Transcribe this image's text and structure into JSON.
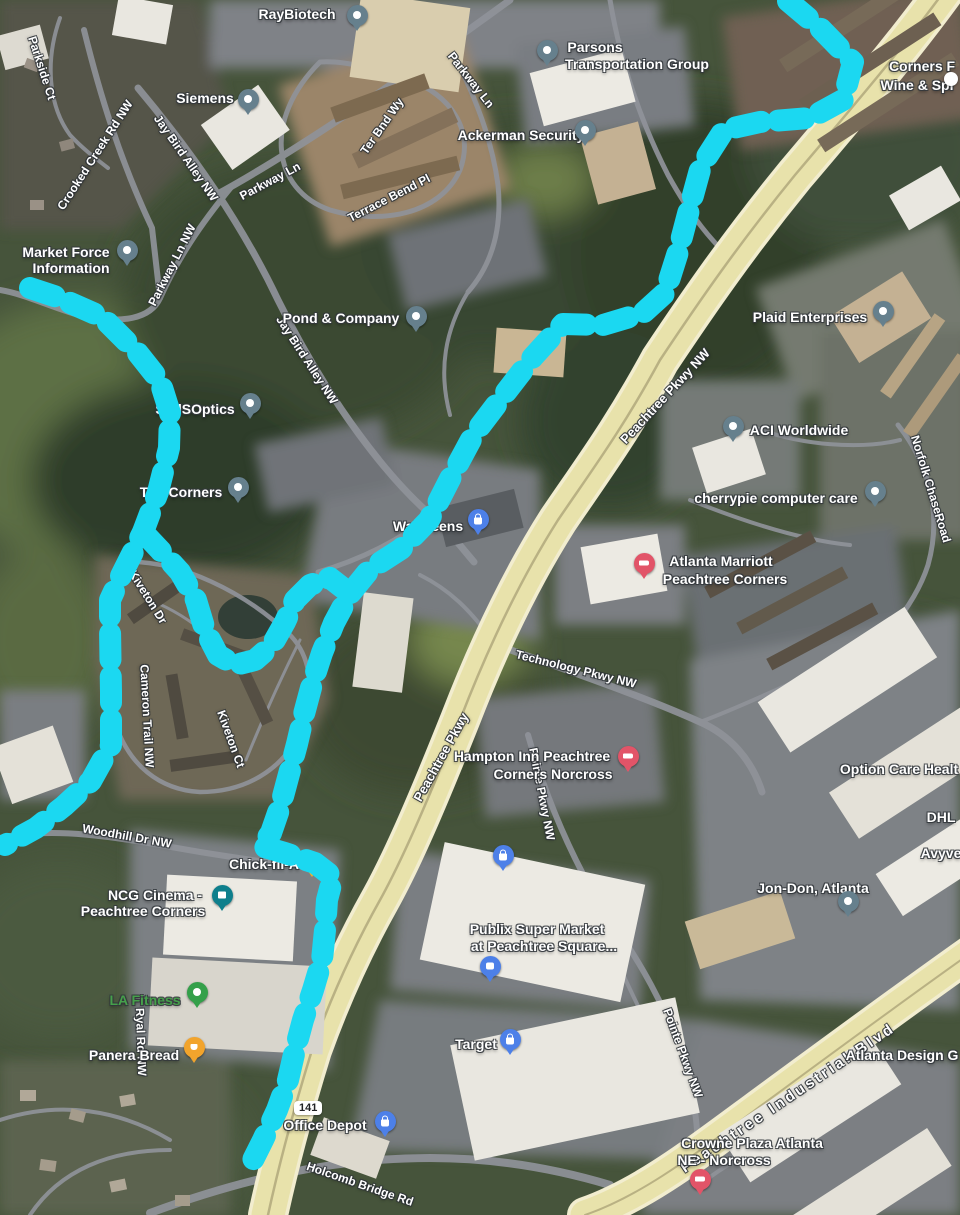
{
  "map_type": "satellite",
  "accent_colors": {
    "route_cyan": "#1bd8f1",
    "highway_fill": "#e8e2ab",
    "pin_generic": "#66808d",
    "pin_shopping": "#4d80e8",
    "pin_hotel": "#e25468",
    "pin_food": "#f2a42c",
    "pin_fitness": "#34a04a",
    "pin_movie": "#0e7f8c",
    "la_fitness_text": "#46a04b"
  },
  "shield": {
    "label": "141",
    "x": 307,
    "y": 1110
  },
  "place_labels": [
    {
      "name": "raybiotech",
      "text": "RayBiotech",
      "x": 297,
      "y": 14
    },
    {
      "name": "parsons-line1",
      "text": "Parsons",
      "x": 595,
      "y": 47
    },
    {
      "name": "parsons-line2",
      "text": "Transportation Group",
      "x": 637,
      "y": 64
    },
    {
      "name": "siemens",
      "text": "Siemens",
      "x": 205,
      "y": 98
    },
    {
      "name": "ackerman-security",
      "text": "Ackerman Security",
      "x": 521,
      "y": 135
    },
    {
      "name": "corners-wine-line1",
      "text": "Corners F",
      "x": 922,
      "y": 66
    },
    {
      "name": "corners-wine-line2",
      "text": "Wine & Spi",
      "x": 917,
      "y": 85
    },
    {
      "name": "market-force-line1",
      "text": "Market Force",
      "x": 66,
      "y": 252
    },
    {
      "name": "market-force-line2",
      "text": "Information",
      "x": 71,
      "y": 268
    },
    {
      "name": "pond-company",
      "text": "Pond & Company",
      "x": 341,
      "y": 318
    },
    {
      "name": "plaid-enterprises",
      "text": "Plaid Enterprises",
      "x": 810,
      "y": 317
    },
    {
      "name": "sddsoptics",
      "text": "SddSOptics",
      "x": 195,
      "y": 409
    },
    {
      "name": "aci-worldwide",
      "text": "ACI Worldwide",
      "x": 799,
      "y": 430
    },
    {
      "name": "cherrypie",
      "text": "cherrypie computer care",
      "x": 776,
      "y": 498
    },
    {
      "name": "the-corners",
      "text": "The Corners",
      "x": 181,
      "y": 492
    },
    {
      "name": "walgreens",
      "text": "Walgreens",
      "x": 428,
      "y": 526
    },
    {
      "name": "marriott-line1",
      "text": "Atlanta Marriott",
      "x": 721,
      "y": 561
    },
    {
      "name": "marriott-line2",
      "text": "Peachtree Corners",
      "x": 725,
      "y": 579
    },
    {
      "name": "hampton-line1",
      "text": "Hampton Inn Peachtree",
      "x": 532,
      "y": 756
    },
    {
      "name": "hampton-line2",
      "text": "Corners Norcross",
      "x": 553,
      "y": 774
    },
    {
      "name": "option-care",
      "text": "Option Care Healt",
      "x": 899,
      "y": 769
    },
    {
      "name": "dhl",
      "text": "DHL",
      "x": 941,
      "y": 817
    },
    {
      "name": "avyve",
      "text": "Avyve",
      "x": 941,
      "y": 853
    },
    {
      "name": "jon-don",
      "text": "Jon-Don, Atlanta",
      "x": 813,
      "y": 888
    },
    {
      "name": "chick-fil-a",
      "text": "Chick-fil-A",
      "x": 264,
      "y": 864
    },
    {
      "name": "ncg-line1",
      "text": "NCG Cinema -",
      "x": 155,
      "y": 895
    },
    {
      "name": "ncg-line2",
      "text": "Peachtree Corners",
      "x": 143,
      "y": 911
    },
    {
      "name": "publix-line1",
      "text": "Publix Super Market",
      "x": 537,
      "y": 929
    },
    {
      "name": "publix-line2",
      "text": "at Peachtree Square...",
      "x": 544,
      "y": 946
    },
    {
      "name": "la-fitness",
      "text": "LA Fitness",
      "x": 145,
      "y": 1000,
      "color": "#46a04b"
    },
    {
      "name": "panera-bread",
      "text": "Panera Bread",
      "x": 134,
      "y": 1055
    },
    {
      "name": "target",
      "text": "Target",
      "x": 476,
      "y": 1044
    },
    {
      "name": "atlanta-design",
      "text": "Atlanta Design G",
      "x": 902,
      "y": 1055
    },
    {
      "name": "office-depot",
      "text": "Office Depot",
      "x": 325,
      "y": 1125
    },
    {
      "name": "crowne-line1",
      "text": "Crowne Plaza Atlanta",
      "x": 752,
      "y": 1143
    },
    {
      "name": "crowne-line2",
      "text": "NE - Norcross",
      "x": 724,
      "y": 1160
    }
  ],
  "road_labels": [
    {
      "name": "parkside-ct",
      "text": "Parkside Ct",
      "x": 42,
      "y": 68,
      "rot": 72,
      "size": 12
    },
    {
      "name": "crooked-creek-rd",
      "text": "Crooked Creek Rd NW",
      "x": 95,
      "y": 155,
      "rot": -57,
      "size": 12
    },
    {
      "name": "jay-bird-alley-1",
      "text": "Jay Bird Alley NW",
      "x": 186,
      "y": 158,
      "rot": 55,
      "size": 12
    },
    {
      "name": "parkway-ln-1",
      "text": "Parkway Ln",
      "x": 270,
      "y": 181,
      "rot": -28,
      "size": 12
    },
    {
      "name": "parkway-ln-2",
      "text": "Parkway Ln",
      "x": 471,
      "y": 80,
      "rot": 52,
      "size": 12
    },
    {
      "name": "ter-bnd-wy",
      "text": "Ter Bnd Wy",
      "x": 382,
      "y": 126,
      "rot": -55,
      "size": 12
    },
    {
      "name": "terrace-bend-pl",
      "text": "Terrace Bend Pl",
      "x": 389,
      "y": 198,
      "rot": -27,
      "size": 12
    },
    {
      "name": "parkway-ln-nw",
      "text": "Parkway Ln NW",
      "x": 172,
      "y": 265,
      "rot": -63,
      "size": 12
    },
    {
      "name": "jay-bird-alley-2",
      "text": "Jay Bird Alley NW",
      "x": 307,
      "y": 360,
      "rot": 57,
      "size": 12
    },
    {
      "name": "peachtree-pkwy-nw",
      "text": "Peachtree Pkwy NW",
      "x": 665,
      "y": 396,
      "rot": -47,
      "size": 13
    },
    {
      "name": "norfolk-chase-road",
      "text": "Norfolk ChaseRoad",
      "x": 931,
      "y": 489,
      "rot": 73,
      "size": 12
    },
    {
      "name": "technology-pkwy",
      "text": "Technology Pkwy NW",
      "x": 576,
      "y": 669,
      "rot": 14,
      "size": 12
    },
    {
      "name": "peachtree-pkwy",
      "text": "Peachtree Pkwy",
      "x": 441,
      "y": 757,
      "rot": -61,
      "size": 13
    },
    {
      "name": "pointe-pkwy-1",
      "text": "Pointe Pkwy NW",
      "x": 542,
      "y": 794,
      "rot": 79,
      "size": 12
    },
    {
      "name": "kiveton-dr",
      "text": "Kiveton Dr",
      "x": 148,
      "y": 597,
      "rot": 58,
      "size": 12
    },
    {
      "name": "cameron-trail",
      "text": "Cameron Trail NW",
      "x": 147,
      "y": 716,
      "rot": 87,
      "size": 12
    },
    {
      "name": "kiveton-ct",
      "text": "Kiveton Ct",
      "x": 231,
      "y": 739,
      "rot": 70,
      "size": 12
    },
    {
      "name": "woodhill-dr",
      "text": "Woodhill Dr NW",
      "x": 127,
      "y": 836,
      "rot": 10,
      "size": 12
    },
    {
      "name": "ryal-rd",
      "text": "Ryal Rd NW",
      "x": 141,
      "y": 1042,
      "rot": 88,
      "size": 12
    },
    {
      "name": "pointe-pkwy-2",
      "text": "Pointe Pkwy NW",
      "x": 683,
      "y": 1053,
      "rot": 70,
      "size": 12
    },
    {
      "name": "holcomb-bridge-rd",
      "text": "Holcomb Bridge Rd",
      "x": 360,
      "y": 1184,
      "rot": 19,
      "size": 12
    },
    {
      "name": "peachtree-industrial",
      "text": "Peachtree Industrial Blvd",
      "x": 788,
      "y": 1098,
      "rot": -34,
      "size": 15,
      "ls": 3
    }
  ],
  "pins": [
    {
      "name": "raybiotech-pin",
      "type": "generic",
      "x": 357,
      "y": 15
    },
    {
      "name": "parsons-pin",
      "type": "generic",
      "x": 547,
      "y": 50
    },
    {
      "name": "siemens-pin",
      "type": "generic",
      "x": 248,
      "y": 99
    },
    {
      "name": "ackerman-pin",
      "type": "generic",
      "x": 585,
      "y": 130
    },
    {
      "name": "market-force-pin",
      "type": "generic",
      "x": 127,
      "y": 250
    },
    {
      "name": "pond-company-pin",
      "type": "generic",
      "x": 416,
      "y": 316
    },
    {
      "name": "plaid-pin",
      "type": "generic",
      "x": 883,
      "y": 311
    },
    {
      "name": "sddsoptics-pin",
      "type": "generic",
      "x": 250,
      "y": 403
    },
    {
      "name": "aci-pin",
      "type": "generic",
      "x": 733,
      "y": 426
    },
    {
      "name": "cherrypie-pin",
      "type": "generic",
      "x": 875,
      "y": 491
    },
    {
      "name": "the-corners-pin",
      "type": "generic",
      "x": 238,
      "y": 487
    },
    {
      "name": "jon-don-pin",
      "type": "generic",
      "x": 848,
      "y": 901
    },
    {
      "name": "ncg-cinema-pin",
      "type": "movie",
      "x": 222,
      "y": 895
    },
    {
      "name": "walgreens-pin",
      "type": "bag",
      "x": 478,
      "y": 519
    },
    {
      "name": "shopping-pin-unlabeled",
      "type": "bag",
      "x": 503,
      "y": 855
    },
    {
      "name": "target-pin",
      "type": "bag",
      "x": 510,
      "y": 1039
    },
    {
      "name": "office-depot-pin",
      "type": "bag",
      "x": 385,
      "y": 1121
    },
    {
      "name": "publix-pin",
      "type": "cart",
      "x": 490,
      "y": 966
    },
    {
      "name": "marriott-pin",
      "type": "hotel",
      "x": 644,
      "y": 563
    },
    {
      "name": "hampton-pin",
      "type": "hotel",
      "x": 628,
      "y": 756
    },
    {
      "name": "crowne-plaza-pin",
      "type": "hotel",
      "x": 700,
      "y": 1179
    },
    {
      "name": "la-fitness-pin",
      "type": "fitness",
      "x": 197,
      "y": 992
    },
    {
      "name": "panera-pin",
      "type": "food",
      "x": 194,
      "y": 1047
    }
  ],
  "partial_markers": [
    {
      "name": "corners-wine-pin-partial",
      "kind": "white-dot",
      "x": 951,
      "y": 79,
      "d": 14
    },
    {
      "name": "chick-fil-a-marker",
      "kind": "cfa",
      "x": 312,
      "y": 872
    }
  ],
  "route": {
    "color": "#1bd8f1",
    "width": 22,
    "dash": [
      26,
      17
    ],
    "paths": [
      [
        [
          788,
          1
        ],
        [
          820,
          28
        ],
        [
          853,
          62
        ],
        [
          843,
          100
        ],
        [
          810,
          118
        ],
        [
          760,
          122
        ],
        [
          724,
          130
        ],
        [
          701,
          166
        ],
        [
          689,
          210
        ],
        [
          678,
          252
        ],
        [
          665,
          293
        ],
        [
          643,
          313
        ],
        [
          603,
          325
        ],
        [
          563,
          324
        ],
        [
          533,
          357
        ],
        [
          503,
          396
        ],
        [
          474,
          434
        ],
        [
          451,
          477
        ],
        [
          429,
          520
        ],
        [
          401,
          549
        ],
        [
          370,
          569
        ],
        [
          349,
          595
        ],
        [
          334,
          623
        ],
        [
          322,
          653
        ],
        [
          312,
          684
        ],
        [
          304,
          714
        ],
        [
          297,
          744
        ],
        [
          289,
          774
        ],
        [
          281,
          804
        ],
        [
          271,
          833
        ],
        [
          261,
          846
        ],
        [
          285,
          853
        ],
        [
          315,
          863
        ],
        [
          333,
          877
        ],
        [
          327,
          900
        ],
        [
          325,
          930
        ],
        [
          322,
          960
        ],
        [
          313,
          990
        ],
        [
          303,
          1020
        ],
        [
          295,
          1050
        ],
        [
          288,
          1080
        ],
        [
          277,
          1110
        ],
        [
          263,
          1140
        ],
        [
          253,
          1160
        ]
      ],
      [
        [
          30,
          288
        ],
        [
          57,
          297
        ],
        [
          102,
          317
        ],
        [
          137,
          352
        ],
        [
          160,
          381
        ],
        [
          170,
          413
        ],
        [
          169,
          448
        ],
        [
          158,
          492
        ],
        [
          143,
          532
        ],
        [
          121,
          576
        ],
        [
          110,
          600
        ],
        [
          110,
          628
        ],
        [
          111,
          692
        ],
        [
          111,
          745
        ],
        [
          91,
          781
        ],
        [
          64,
          806
        ],
        [
          36,
          828
        ],
        [
          5,
          845
        ]
      ],
      [
        [
          143,
          532
        ],
        [
          160,
          550
        ],
        [
          180,
          572
        ],
        [
          196,
          600
        ],
        [
          205,
          630
        ],
        [
          218,
          655
        ],
        [
          235,
          665
        ],
        [
          255,
          660
        ],
        [
          272,
          645
        ],
        [
          285,
          622
        ],
        [
          295,
          600
        ],
        [
          310,
          585
        ],
        [
          330,
          578
        ],
        [
          348,
          592
        ]
      ]
    ]
  }
}
